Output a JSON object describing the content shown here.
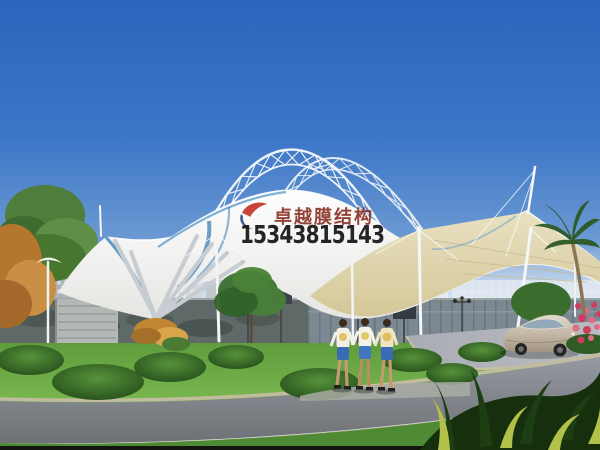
{
  "watermark": {
    "company_name": "卓越膜结构",
    "phone_number": "15343815143",
    "logo": "red-sail-blue-crescent-mark"
  },
  "colors": {
    "sky_top": "#2b66bd",
    "sky_horizon": "#d9e6f2",
    "membrane_white": "#f8f8f5",
    "membrane_underside_cream": "#ddd3a9",
    "membrane_trim_blue": "#4a8fc0",
    "truss_steel": "#f2f6fa",
    "lawn_green": "#5f9c3d",
    "road_gray": "#84888e",
    "wall_gray": "#6e7a78",
    "logo_red": "#c23527",
    "logo_blue": "#2a4d8f",
    "company_text_color": "#8a2f24",
    "phone_text_color": "#141414",
    "car_beige": "#cbbfae",
    "flower_pink": "#d8486a"
  },
  "scene_elements": [
    "sky",
    "steel-truss-arches",
    "tensile-membrane-canopy",
    "masts-and-cables",
    "city-buildings",
    "boundary-wall",
    "stairs",
    "street-lamps",
    "sign-panels",
    "lawn",
    "shrubs",
    "trees",
    "palm-tree",
    "pedestrians",
    "sedan-car",
    "flower-bush",
    "roads",
    "foreground-plants"
  ]
}
